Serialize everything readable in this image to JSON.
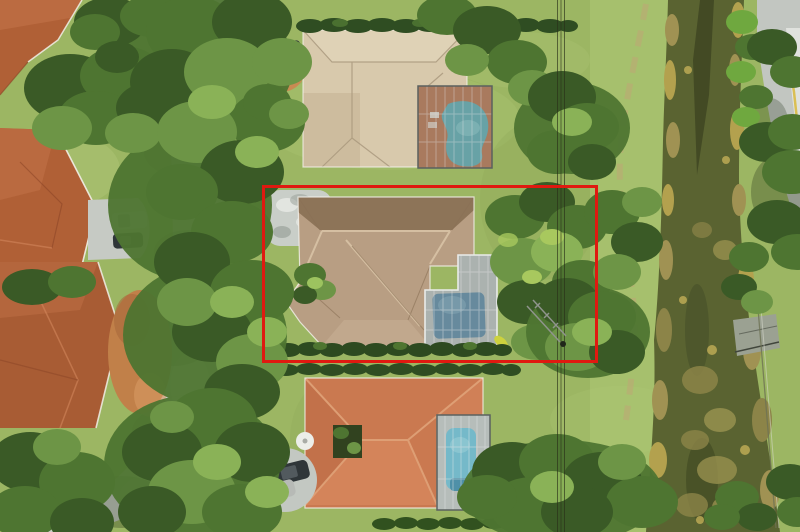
{
  "meta": {
    "type": "aerial-photograph",
    "description": "Overhead drone photo of a suburban lot outlined in red, between two neighboring homes with screened pools, a tree-lined street on the left and a canal with an access road on the right.",
    "width_px": 800,
    "height_px": 532
  },
  "annotation": {
    "label": "property-boundary-box",
    "x": 263,
    "y": 186,
    "width": 334,
    "height": 176,
    "stroke_color": "#e01910",
    "stroke_width": 3
  },
  "palette": {
    "lawn": "#9cb663",
    "lawn_light": "#aec876",
    "tree_dark": "#3a5a26",
    "tree_mid": "#4e7531",
    "tree_light": "#6d9546",
    "tree_highlight": "#8ab257",
    "street": "#c9cdc7",
    "street_bright": "#e8eae5",
    "east_road": "#c2c6c1",
    "road_line_yellow": "#d8b93c",
    "canal_water": "#5a6331",
    "canal_dark": "#394020",
    "algae_tan": "#a09253",
    "algae_gold": "#b3a14e",
    "roof_terracotta": "#b06036",
    "roof_beige": "#d8c9ac",
    "roof_tan": "#b89e83",
    "roof_tan_dark": "#8d7458",
    "roof_orange": "#ca7950",
    "pool_north": "#5ba8ad",
    "pool_subject": "#5b87a0",
    "pool_south": "#6fc3d8",
    "screen_gray": "#98a1a0",
    "deck_terracotta": "#b4714a",
    "dirt": "#c18049",
    "concrete_pad": "#9ba192",
    "car_dark": "#2f3639",
    "car_white": "#e9ebe7",
    "car_silver": "#b7bab6",
    "wire": "#2a3019"
  },
  "features": {
    "subject_lot": {
      "label": "subject-lot-with-tan-roof-home-and-screened-pool"
    },
    "north_house": {
      "label": "north-neighbor-beige-roof-kidney-pool"
    },
    "south_house": {
      "label": "south-neighbor-orange-roof-rect-pool"
    },
    "west_houses": {
      "label": "terracotta-roof-homes-across-street"
    },
    "street": {
      "label": "tree-canopied-residential-street"
    },
    "canal": {
      "label": "canal-waterway-with-algae"
    },
    "east_road": {
      "label": "perimeter-road-with-yellow-edge-line"
    },
    "power_lines": {
      "label": "overhead-utility-wires"
    }
  }
}
